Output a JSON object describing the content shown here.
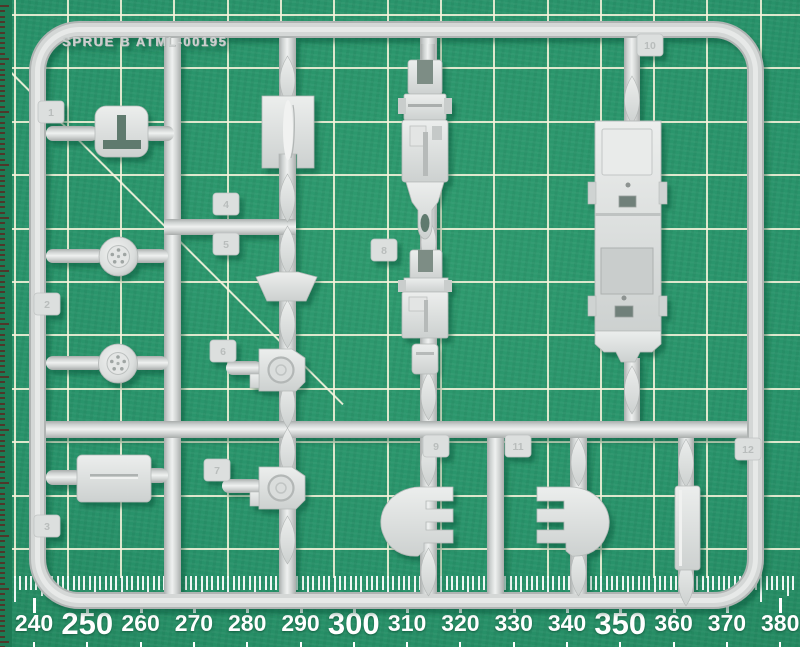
{
  "mat": {
    "ruler": {
      "values": [
        "240",
        "250",
        "260",
        "270",
        "280",
        "290",
        "300",
        "310",
        "320",
        "330",
        "340",
        "350",
        "360",
        "370",
        "380"
      ],
      "major_values": [
        "250",
        "300",
        "350"
      ]
    }
  },
  "sprue": {
    "label": "SPRUE B ATML-00195",
    "tabs": [
      {
        "number": "1",
        "x": 38,
        "y": 101
      },
      {
        "number": "2",
        "x": 34,
        "y": 293
      },
      {
        "number": "3",
        "x": 34,
        "y": 515
      },
      {
        "number": "4",
        "x": 213,
        "y": 193
      },
      {
        "number": "5",
        "x": 213,
        "y": 233
      },
      {
        "number": "6",
        "x": 210,
        "y": 340
      },
      {
        "number": "7",
        "x": 204,
        "y": 459
      },
      {
        "number": "8",
        "x": 371,
        "y": 239
      },
      {
        "number": "9",
        "x": 423,
        "y": 435
      },
      {
        "number": "10",
        "x": 637,
        "y": 34
      },
      {
        "number": "11",
        "x": 505,
        "y": 435
      },
      {
        "number": "12",
        "x": 735,
        "y": 438
      }
    ],
    "parts": [
      "bulkhead-panel-with-t-slot",
      "road-wheel",
      "road-wheel",
      "fuel-tank-half",
      "fin-panel",
      "windscreen-frame",
      "round-hatch",
      "round-hatch",
      "suspension-assembly-upper",
      "suspension-assembly-lower",
      "hull-chassis",
      "track-guard-left",
      "track-guard-right",
      "axle-strip"
    ]
  },
  "colors": {
    "mat_green": "#28926a",
    "mat_green_dark": "#1b7450",
    "grid_line": "#f6f2db",
    "sprue_gray": "#d3d6d5",
    "sprue_shadow": "#a9adac",
    "sprue_highlight": "#eceeed",
    "hole_dark": "#5f7a6e",
    "ruler_text": "#ffffff",
    "edge_tick": "#60201c"
  }
}
